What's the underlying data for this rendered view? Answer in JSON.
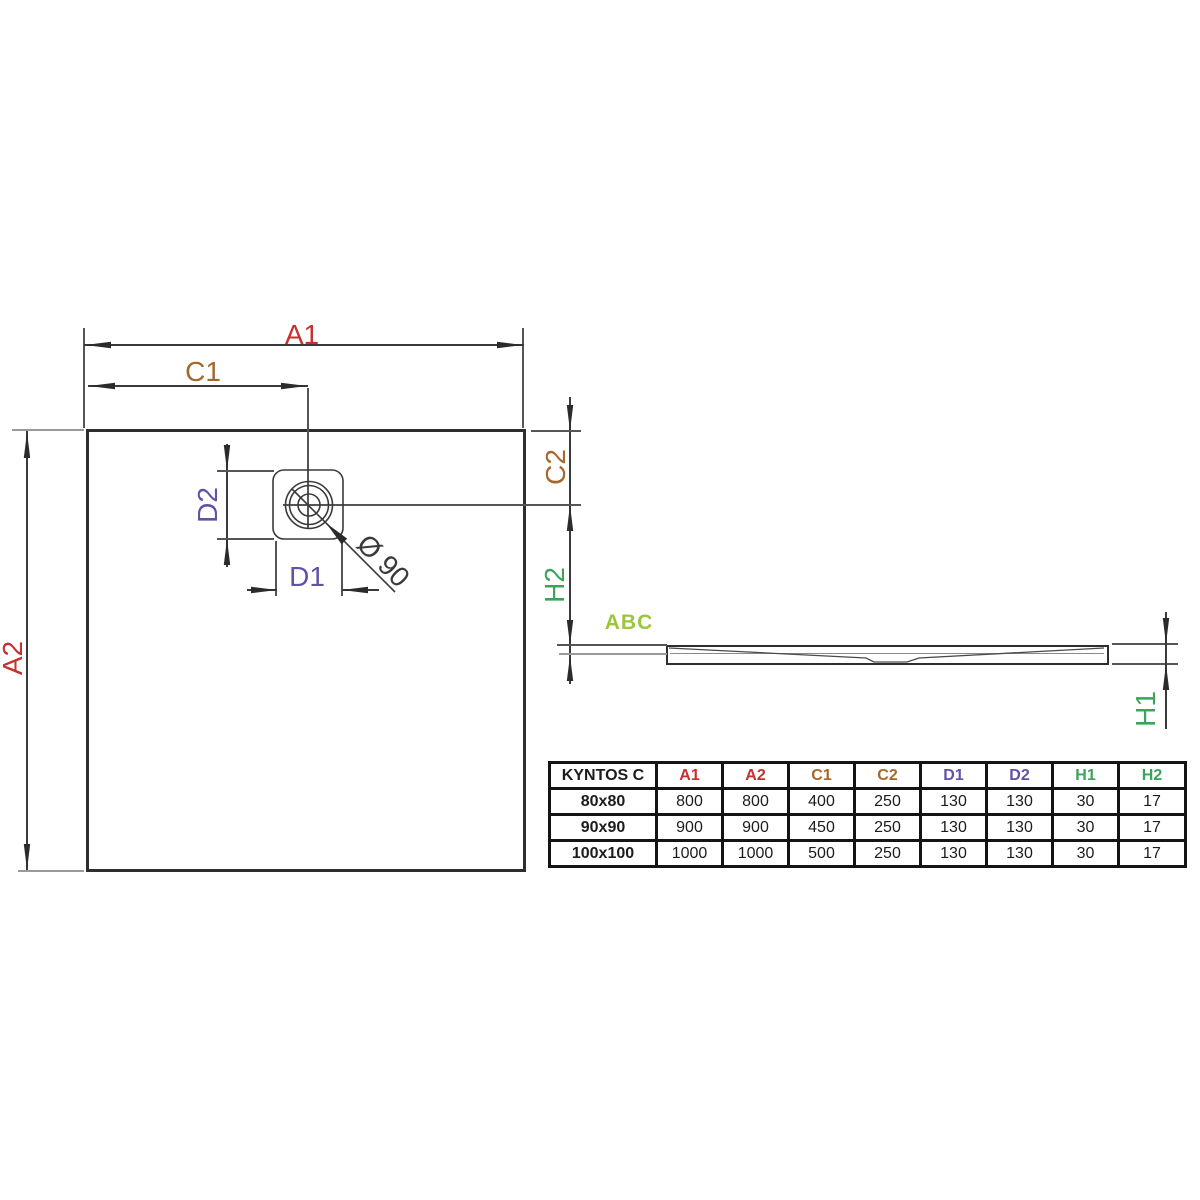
{
  "drawing": {
    "labels": {
      "a1": "A1",
      "a2": "A2",
      "c1": "C1",
      "c2": "C2",
      "d1": "D1",
      "d2": "D2",
      "h1": "H1",
      "h2": "H2",
      "diameter": "Ø 90",
      "watermark": "ABC"
    },
    "colors": {
      "red": "#c6302f",
      "brown": "#a5682c",
      "purple": "#6351a6",
      "green": "#3ba45a",
      "lime": "#9bc63d",
      "line": "#3a3a3a"
    }
  },
  "table": {
    "columns": [
      "KYNTOS C",
      "A1",
      "A2",
      "C1",
      "C2",
      "D1",
      "D2",
      "H1",
      "H2"
    ],
    "col_colors": [
      "#1c1c1c",
      "#c6302f",
      "#c6302f",
      "#a5682c",
      "#a5682c",
      "#6351a6",
      "#6351a6",
      "#3ba45a",
      "#3ba45a"
    ],
    "rows": [
      [
        "80x80",
        "800",
        "800",
        "400",
        "250",
        "130",
        "130",
        "30",
        "17"
      ],
      [
        "90x90",
        "900",
        "900",
        "450",
        "250",
        "130",
        "130",
        "30",
        "17"
      ],
      [
        "100x100",
        "1000",
        "1000",
        "500",
        "250",
        "130",
        "130",
        "30",
        "17"
      ]
    ]
  }
}
